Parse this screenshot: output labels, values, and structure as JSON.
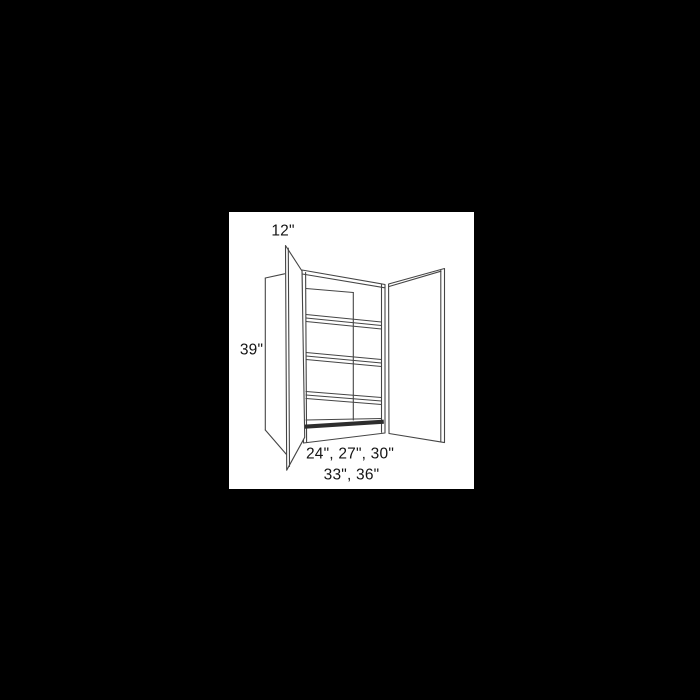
{
  "page": {
    "background_color": "#000000"
  },
  "canvas": {
    "background_color": "#ffffff",
    "line_color": "#454545"
  },
  "drawing": {
    "subject": "Open two-door wall cabinet line drawing with three interior shelves, left side panel and both doors swung open"
  },
  "dimensions": {
    "depth_label": "12\"",
    "height_label": "39\"",
    "width_options_line1": "24\", 27\", 30\"",
    "width_options_line2": "33\", 36\""
  }
}
